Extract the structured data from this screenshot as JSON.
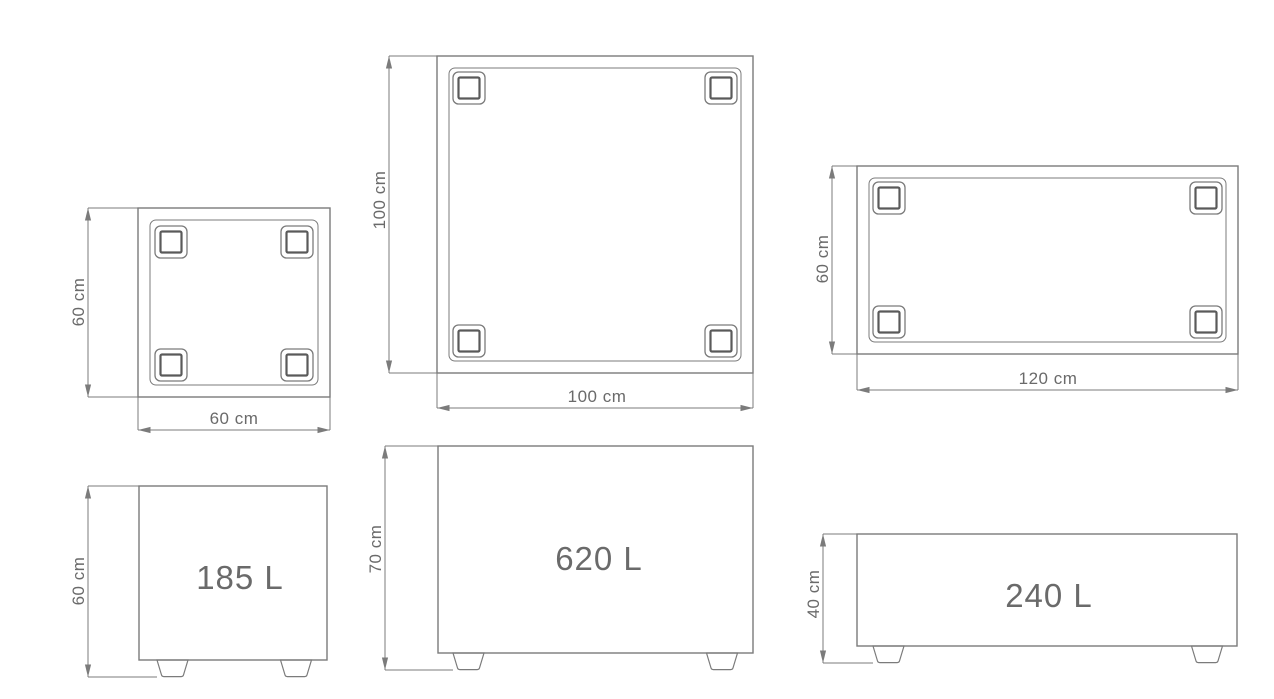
{
  "colors": {
    "line": "#7b7b7b",
    "line_dark": "#5a5a5a",
    "text": "#6a6a6a",
    "background": "#ffffff"
  },
  "products": {
    "small": {
      "bottom_view": {
        "depth_label": "60 cm",
        "width_label": "60 cm"
      },
      "front_view": {
        "height_label": "60 cm",
        "volume_label": "185 L"
      }
    },
    "medium": {
      "bottom_view": {
        "depth_label": "100 cm",
        "width_label": "100 cm"
      },
      "front_view": {
        "height_label": "70 cm",
        "volume_label": "620 L"
      }
    },
    "wide": {
      "bottom_view": {
        "depth_label": "60 cm",
        "width_label": "120 cm"
      },
      "front_view": {
        "height_label": "40 cm",
        "volume_label": "240 L"
      }
    }
  }
}
